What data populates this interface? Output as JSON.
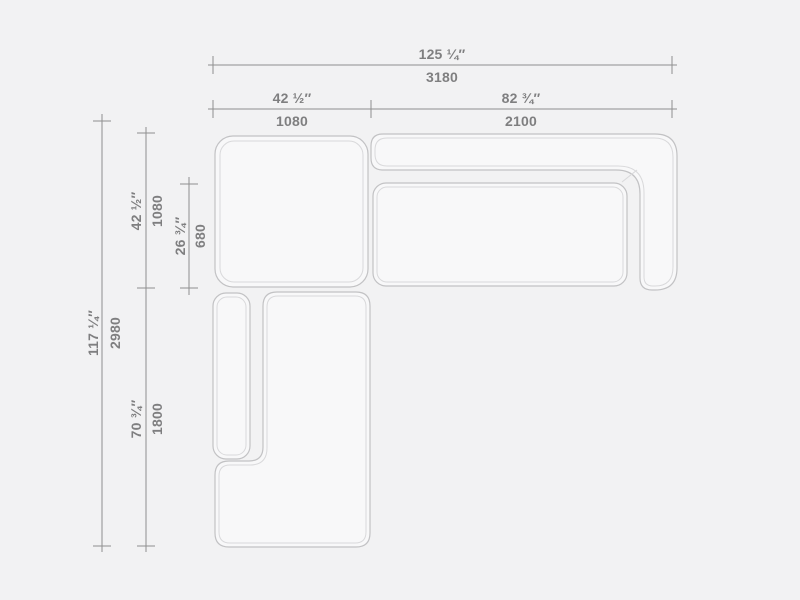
{
  "theme": {
    "bg": "#f2f2f3",
    "dim-line": "#8f8f8f",
    "text-color": "#7f7f80",
    "furn-outer": "#c2c2c4",
    "furn-inner": "#d9d9db",
    "furn-fill": "#f8f8f9"
  },
  "diagram": {
    "dims": {
      "overall_width": {
        "in": "125 ¼″",
        "mm": "3180"
      },
      "module_width_left": {
        "in": "42 ½″",
        "mm": "1080"
      },
      "module_width_right": {
        "in": "82 ¾″",
        "mm": "2100"
      },
      "overall_depth": {
        "in": "117 ¼″",
        "mm": "2980"
      },
      "module_depth_top": {
        "in": "42 ½″",
        "mm": "1080"
      },
      "seat_depth": {
        "in": "26 ¾″",
        "mm": "680"
      },
      "module_depth_bottom": {
        "in": "70 ¾″",
        "mm": "1800"
      }
    }
  }
}
